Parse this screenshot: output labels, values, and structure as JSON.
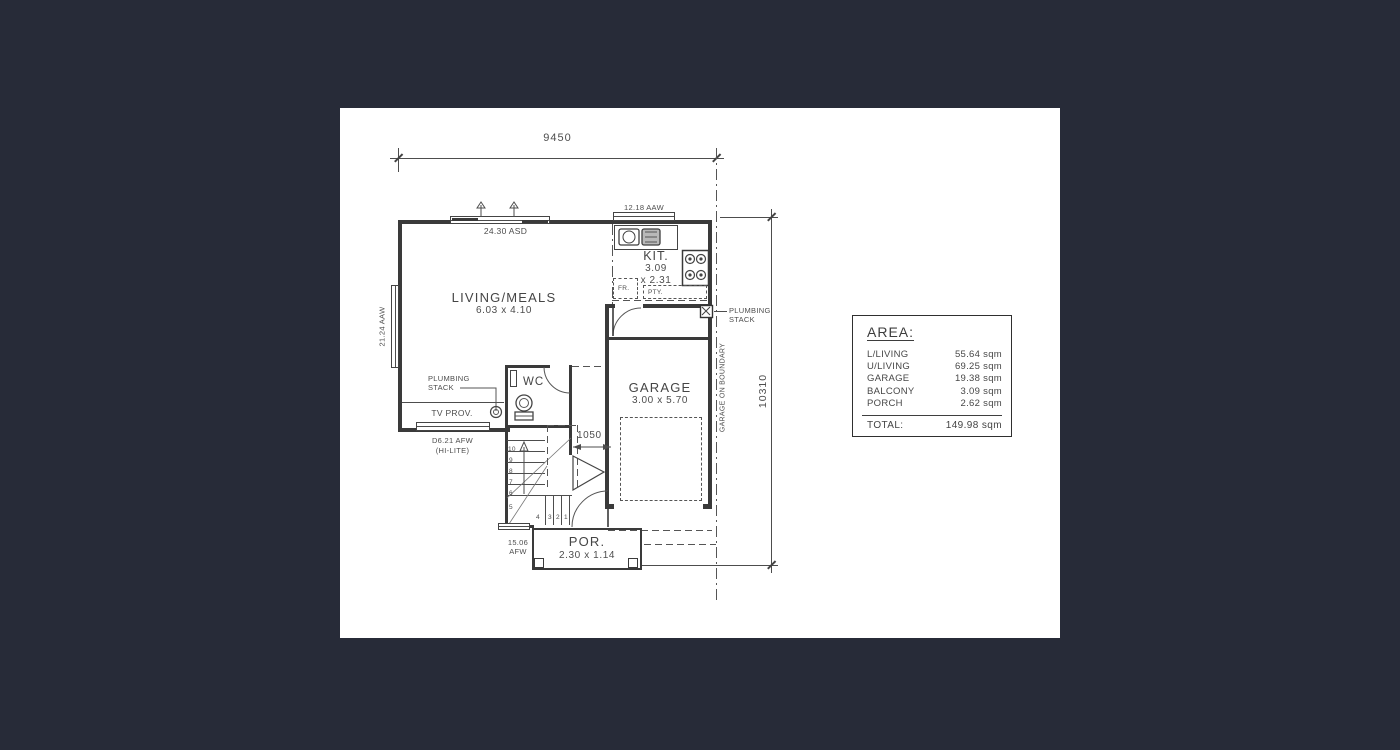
{
  "colors": {
    "page_bg": "#272b38",
    "canvas_bg": "#ffffff",
    "line": "#4d4d4d",
    "wall": "#3a3a3a"
  },
  "dimensions": {
    "width_top": "9450",
    "height_right": "10310",
    "stair_landing": "1050"
  },
  "rooms": {
    "living": {
      "name": "LIVING/MEALS",
      "size": "6.03 x 4.10"
    },
    "kitchen": {
      "name": "KIT.",
      "size_w": "3.09",
      "size_d": "x 2.31"
    },
    "garage": {
      "name": "GARAGE",
      "size": "3.00 x 5.70"
    },
    "wc": {
      "name": "WC"
    },
    "porch": {
      "name": "POR.",
      "size": "2.30 x 1.14"
    }
  },
  "annotations": {
    "window_slider_top": "24.30 ASD",
    "window_kitchen": "12.18 AAW",
    "window_left": "21.24 AAW",
    "window_tv_line1": "D6.21 AFW",
    "window_tv_line2": "(HI-LITE)",
    "window_porch_line1": "15.06",
    "window_porch_line2": "AFW",
    "plumbing_left_line1": "PLUMBING",
    "plumbing_left_line2": "STACK",
    "plumbing_right_line1": "PLUMBING",
    "plumbing_right_line2": "STACK",
    "tv_provision": "TV PROV.",
    "boundary_note": "GARAGE ON BOUNDARY",
    "fridge": "FR.",
    "pantry": "PTY."
  },
  "stairs": {
    "side_numbers": [
      "10",
      "9",
      "8",
      "7",
      "6",
      "5"
    ],
    "bottom_numbers": [
      "4",
      "3",
      "2",
      "1"
    ]
  },
  "area_table": {
    "title": "AREA:",
    "rows": [
      {
        "label": "L/LIVING",
        "value": "55.64 sqm"
      },
      {
        "label": "U/LIVING",
        "value": "69.25 sqm"
      },
      {
        "label": "GARAGE",
        "value": "19.38 sqm"
      },
      {
        "label": "BALCONY",
        "value": "3.09 sqm"
      },
      {
        "label": "PORCH",
        "value": "2.62 sqm"
      }
    ],
    "total_label": "TOTAL:",
    "total_value": "149.98 sqm"
  }
}
